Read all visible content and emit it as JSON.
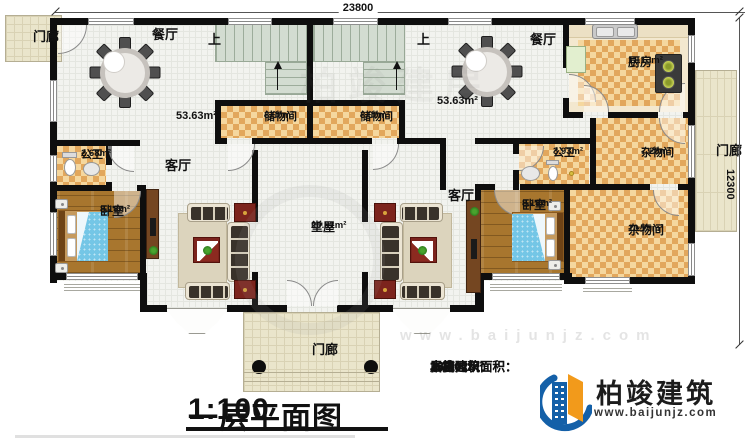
{
  "dimensions": {
    "top": "23800",
    "right": "12300"
  },
  "rooms": {
    "porch_top_left": "门廊",
    "porch_right": "门廊",
    "porch_bottom": "门廊",
    "dining_left": "餐厅",
    "dining_right": "餐厅",
    "dining_left_area": "53.63m²",
    "dining_right_area": "53.63m²",
    "stairs_up_left": "上",
    "stairs_up_right": "上",
    "storage_left": {
      "name": "储物间",
      "area": "3.00m²"
    },
    "storage_right": {
      "name": "储物间",
      "area": "3.00m²"
    },
    "kitchen": {
      "name": "厨房",
      "area": "11.13m²"
    },
    "bath_left": {
      "name": "公卫",
      "area": "2.68m²"
    },
    "bath_right": {
      "name": "公卫",
      "area": "3.93m²"
    },
    "utility_upper": {
      "name": "杂物间",
      "area": "7.28m²"
    },
    "utility_lower": {
      "name": "杂物间",
      "area": "10.75m²"
    },
    "living_left": "客厅",
    "living_right": "客厅",
    "bedroom_left": {
      "name": "卧室",
      "area": "8.18m²"
    },
    "bedroom_right": {
      "name": "卧室",
      "area": "8.18m²"
    },
    "hall": {
      "name": "堂屋",
      "area": "20.91m²"
    }
  },
  "title_block": {
    "title": "一层平面图",
    "scale": "1:100",
    "stats": [
      {
        "label": "本层建筑面积：",
        "value": "180.01m²"
      },
      {
        "label": "本栋建筑面积：",
        "value": "360.02m²"
      },
      {
        "label": "占地面积：",
        "value": "180.01m²"
      },
      {
        "label": "层高：",
        "value": "3.6m"
      }
    ]
  },
  "brand": {
    "name": "柏竣建筑",
    "website": "www.baijunjz.com"
  },
  "watermark": {
    "site": "www.baijunjz.com",
    "mark": "柏竣建房"
  },
  "colors": {
    "wall": "#0e0e0e",
    "checker_floor": "#e2a75c",
    "wood_floor": "#a8762e",
    "porch_tile": "#eae5cb",
    "bed_blue": "#74c6e6",
    "brand_blue": "#1460a8",
    "brand_orange": "#f29a1b"
  }
}
